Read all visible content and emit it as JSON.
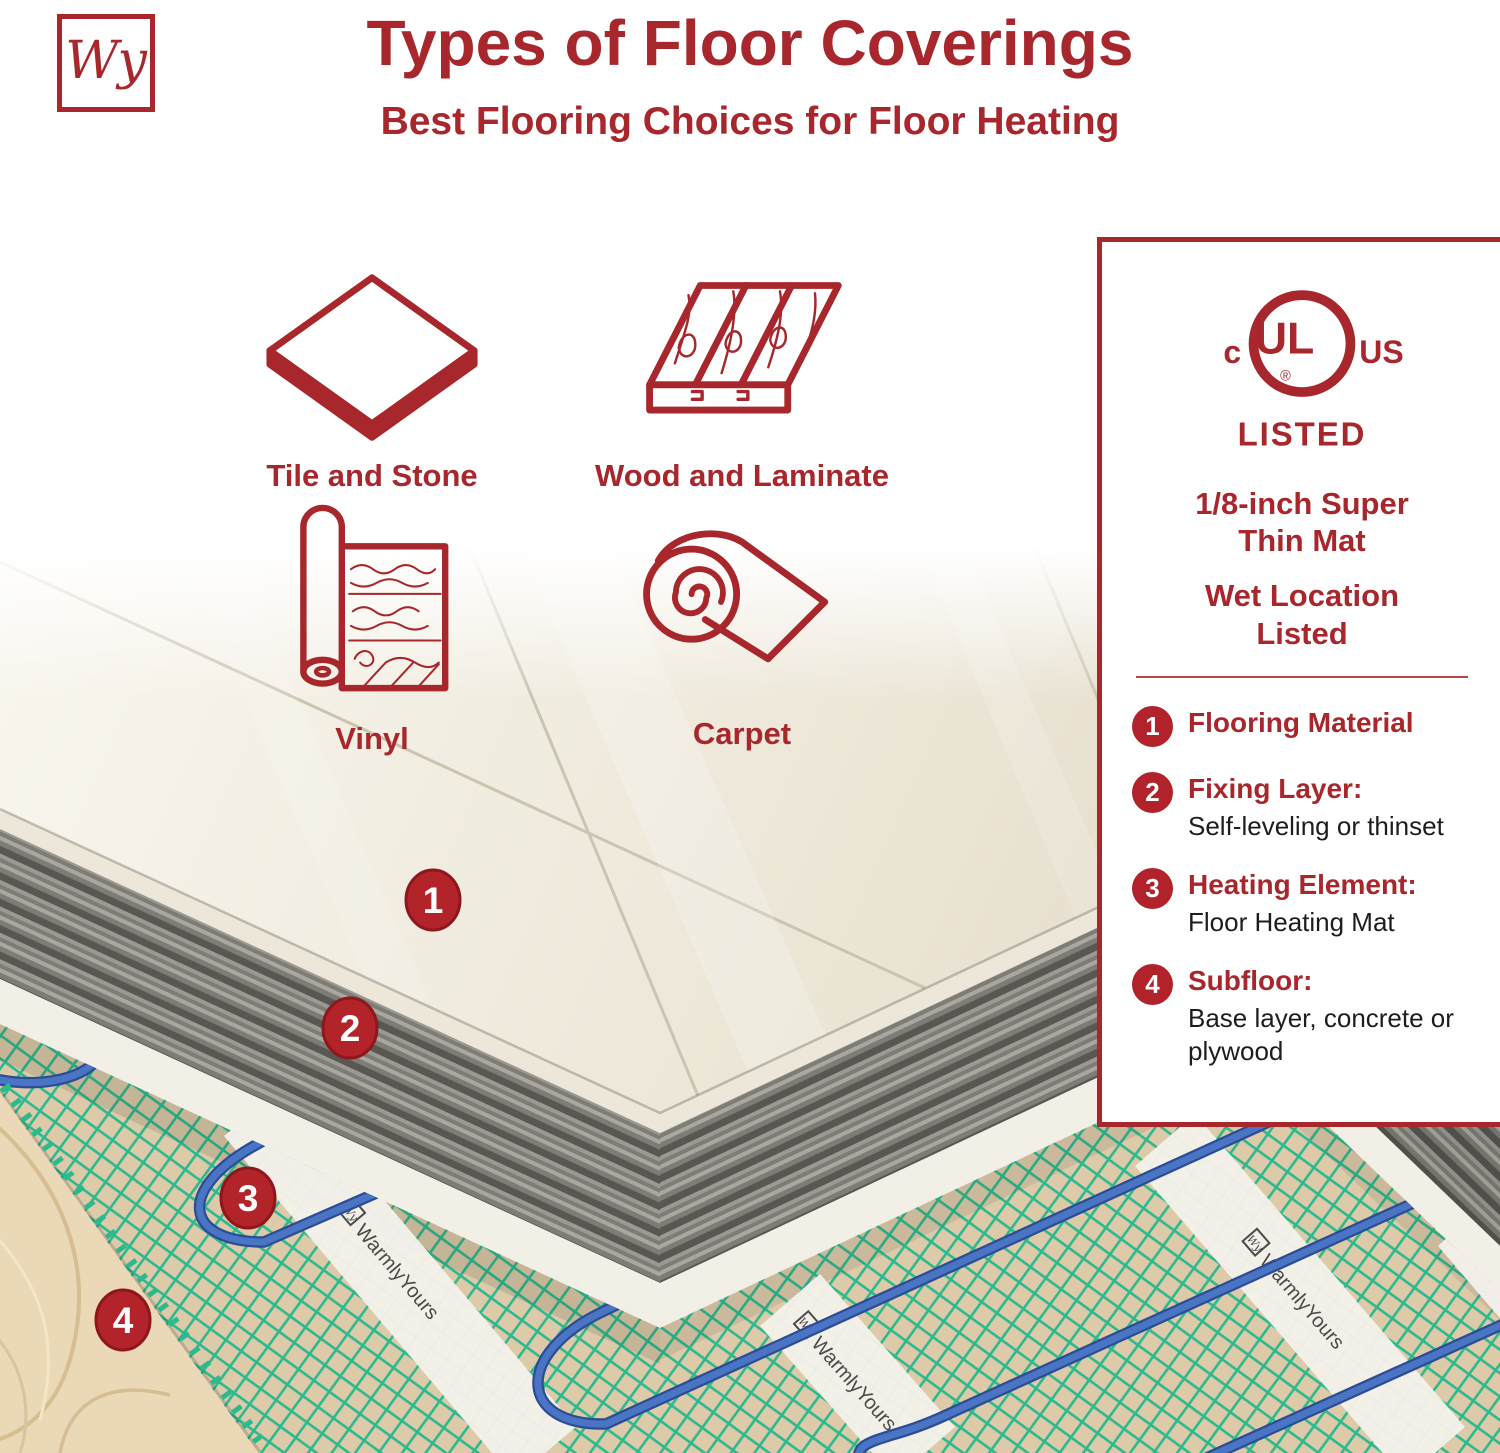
{
  "colors": {
    "accent_red": "#a8272c",
    "badge_red": "#b2222a",
    "mesh_green": "#2db98e",
    "wire_blue": "#3a63b4",
    "thinset_gray": "#7d7c76",
    "tile_cream": "#efe9dc",
    "plywood_tan": "#ead8b6",
    "mat_beige": "#dccaa9",
    "strip_white": "#f4f1ea"
  },
  "header": {
    "logo": "Wy",
    "title": "Types of Floor Coverings",
    "subtitle": "Best Flooring Choices for Floor Heating"
  },
  "flooring_types": [
    {
      "label": "Tile and Stone"
    },
    {
      "label": "Wood and Laminate"
    },
    {
      "label": "Vinyl"
    },
    {
      "label": "Carpet"
    }
  ],
  "panel": {
    "certification": {
      "left": "c",
      "letters": "UL",
      "right": "US",
      "registered": "®",
      "listed": "LISTED"
    },
    "feature1": "1/8-inch Super Thin Mat",
    "feature2": "Wet Location Listed",
    "layers": [
      {
        "num": "1",
        "label": "Flooring Material",
        "desc": ""
      },
      {
        "num": "2",
        "label": "Fixing Layer:",
        "desc": "Self-leveling or thinset"
      },
      {
        "num": "3",
        "label": "Heating Element:",
        "desc": "Floor Heating Mat"
      },
      {
        "num": "4",
        "label": "Subfloor:",
        "desc": "Base layer, concrete or plywood"
      }
    ]
  },
  "scene": {
    "brand_label": "WarmlyYours",
    "brand_logo": "Wy",
    "markers": [
      {
        "num": "1"
      },
      {
        "num": "2"
      },
      {
        "num": "3"
      },
      {
        "num": "4"
      }
    ]
  }
}
